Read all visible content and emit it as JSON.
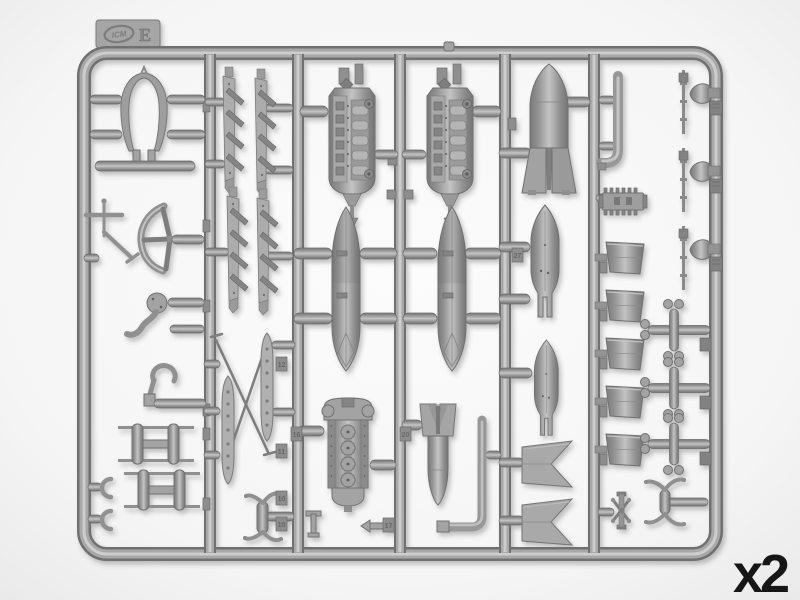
{
  "labels": {
    "quantity": "x2"
  },
  "sprue_tag": {
    "letter": "E",
    "brand": "ICM"
  },
  "part_number_tabs": [
    {
      "label": "12"
    },
    {
      "label": "16"
    },
    {
      "label": "11"
    },
    {
      "label": "10"
    },
    {
      "label": "10"
    },
    {
      "label": "20"
    },
    {
      "label": "17"
    },
    {
      "label": "27"
    }
  ],
  "colors": {
    "background": "#f4f4f4",
    "plastic": "#9c9c9c",
    "plastic_dark": "#6f6f6f",
    "plastic_light": "#cacaca",
    "label_text": "#161616"
  }
}
